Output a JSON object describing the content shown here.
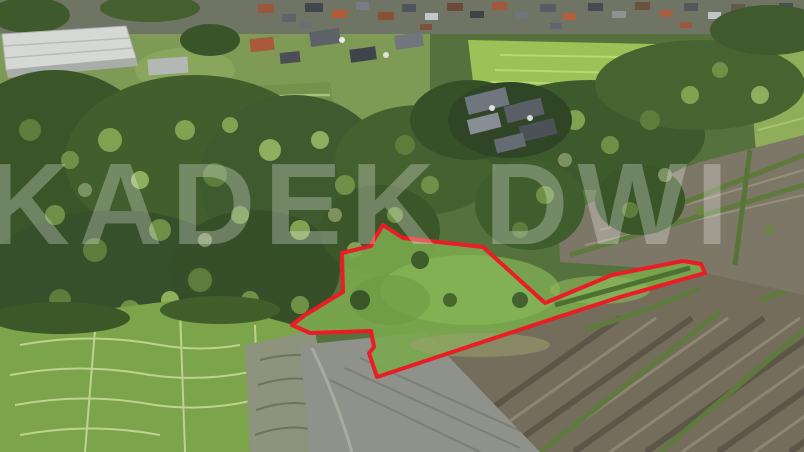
{
  "watermark": {
    "text": "KADEK DWI",
    "color": "#ffffff",
    "opacity": 0.27
  },
  "plot_overlay": {
    "outline_color": "#ea1c26",
    "outline_width": 4,
    "points": "383,225 403,238 483,247 545,303 612,275 683,261 701,264 705,273 620,297 543,322 377,377 369,353 374,347 371,331 310,333 292,325 305,315 343,292 342,253 371,246 375,238"
  },
  "palette": {
    "forest_green": "#3c5a2e",
    "canopy_highlight": "#6f9147",
    "plot_meadow_green": "#7aa84d",
    "rice_field_bright": "#9cc157",
    "paddy_green": "#7ba44b",
    "terrace_green": "#75924c",
    "wet_field_gray": "#8f918b",
    "tilled_field_brown": "#746d5b",
    "terraced_dry_gray": "#7d7767",
    "village_base": "#6f7464",
    "roof_orange": "#b05c36",
    "roof_gray": "#6e747c",
    "building_white": "#d7dad6",
    "outline_red": "#ea1c26"
  }
}
